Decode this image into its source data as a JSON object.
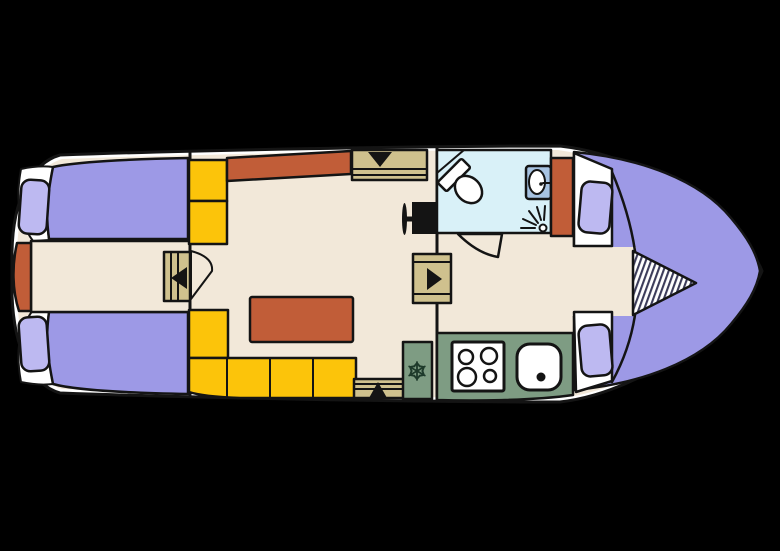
{
  "plan": {
    "type": "boat-deck-floor-plan",
    "areas": [
      "aft-cabin",
      "saloon",
      "bathroom",
      "galley",
      "bow-cabin"
    ],
    "fixtures": [
      "aft-berth-top",
      "aft-berth-bottom",
      "engine-hatch",
      "storage-cabinets",
      "sideboard",
      "companionway-steps-top",
      "companionway-steps-bottom",
      "saloon-table",
      "tv",
      "toilet",
      "washbasin",
      "shower-head",
      "wardrobe",
      "fridge",
      "stove",
      "galley-sink",
      "bow-berth",
      "berth-insert-cushion",
      "cabin-door-aft",
      "cabin-door-fwd",
      "bathroom-door"
    ]
  },
  "colors": {
    "background": "#000000",
    "outline": "#141414",
    "hull": "#ffffff",
    "floor": "#f2e8d9",
    "bed": "#9d99e6",
    "pillow": "#bdb9f1",
    "rust": "#c15d38",
    "yellow": "#fcc40a",
    "tan": "#cfc18e",
    "bath": "#d9f1f8",
    "sink": "#a7c3e2",
    "green": "#7e9c83",
    "hatch": "#3c3c5a",
    "snowflake": "#1e3a2b"
  }
}
